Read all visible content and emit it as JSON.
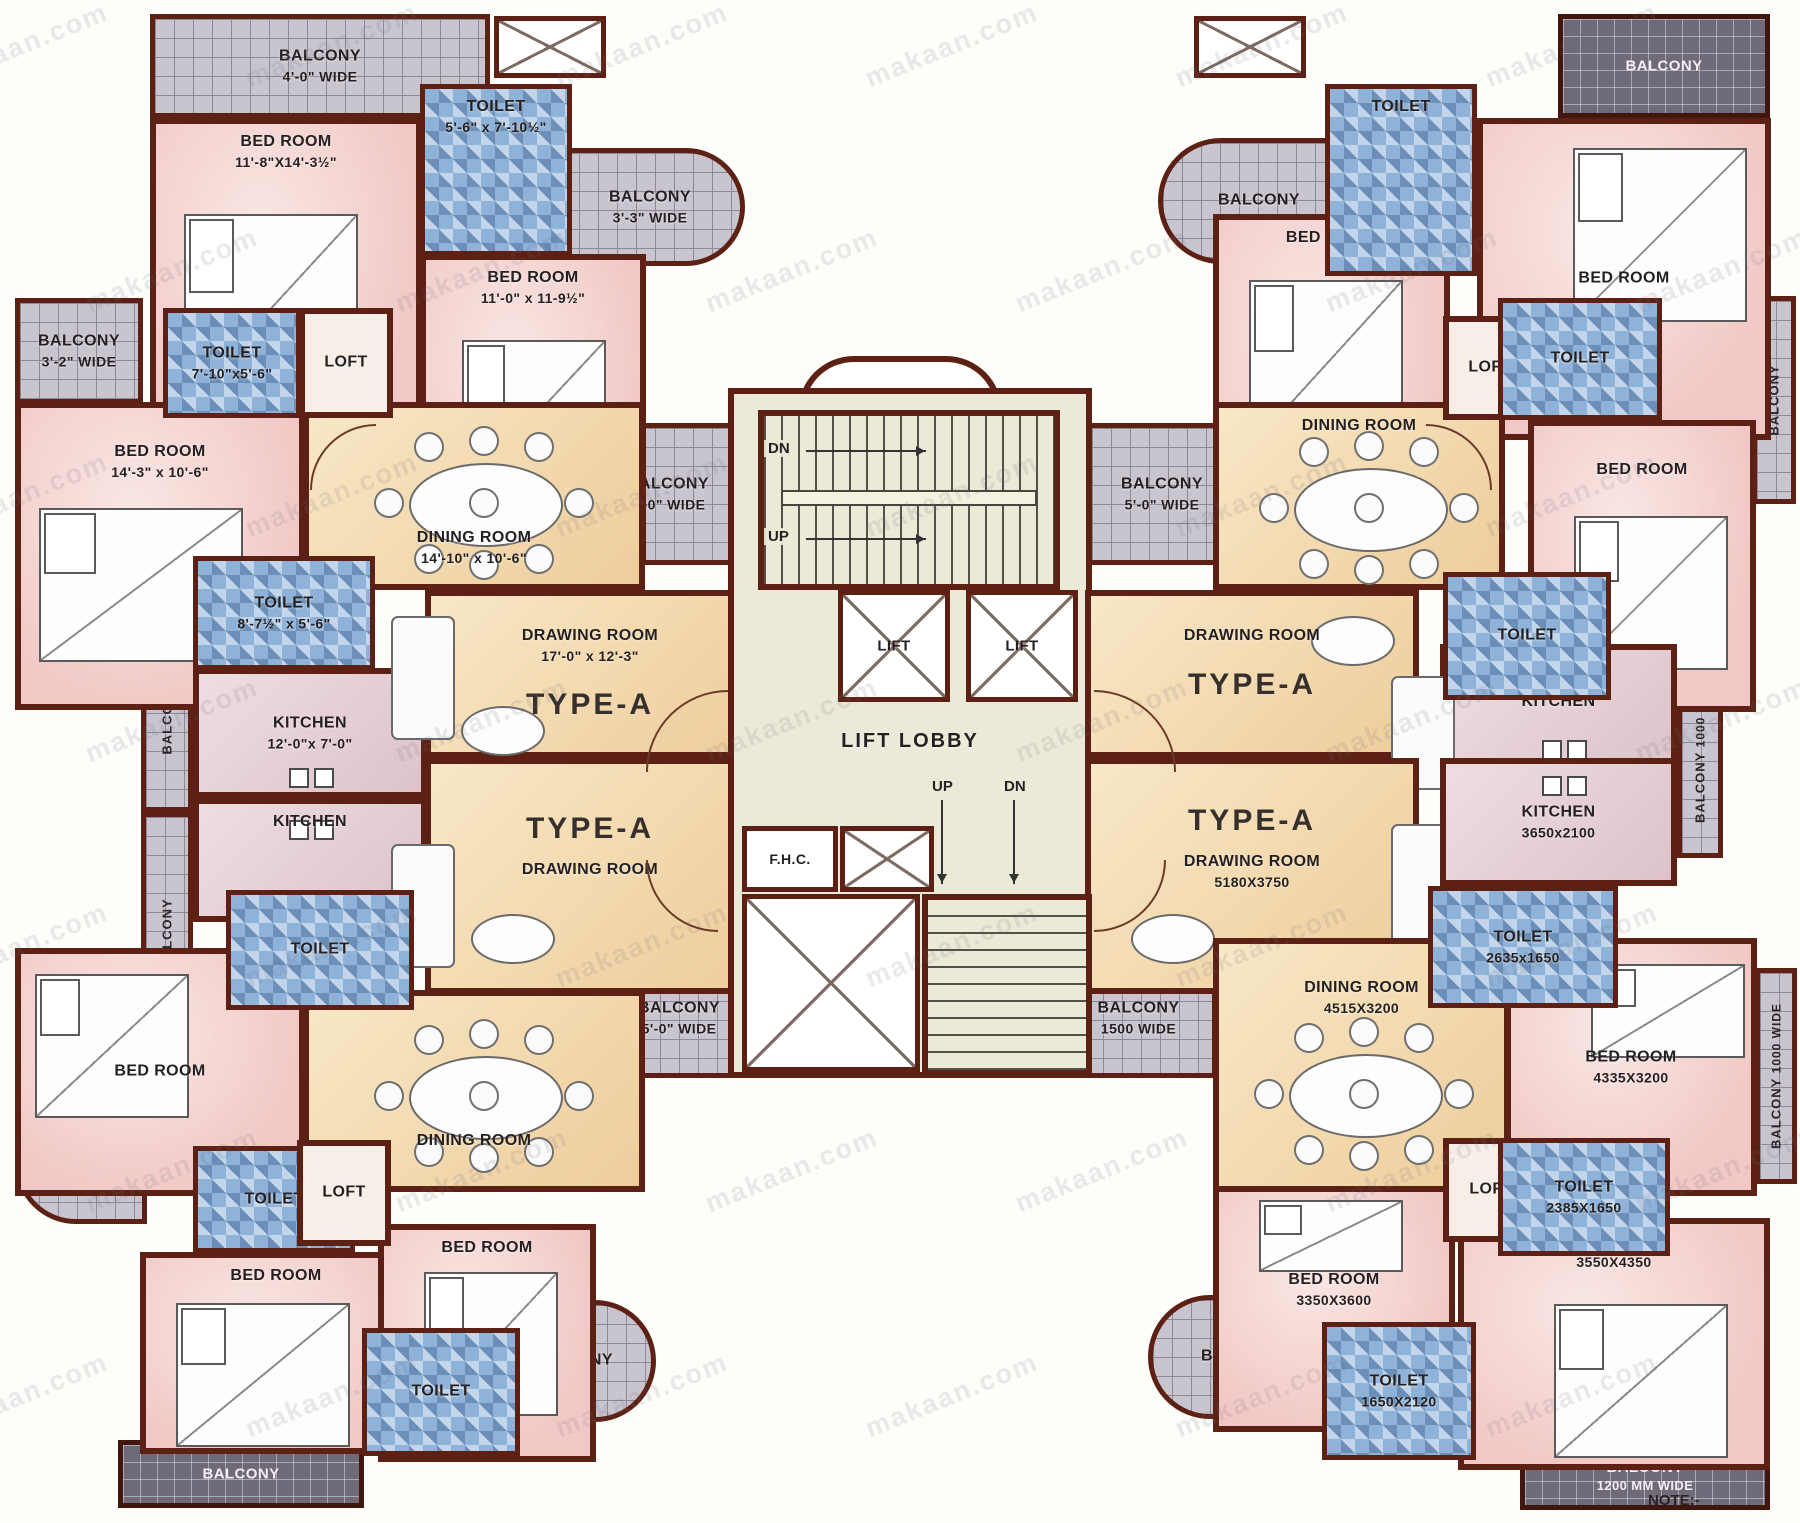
{
  "watermark": "makaan.com",
  "note": "NOTE:-",
  "core": {
    "lift": "LIFT",
    "lobby": "LIFT LOBBY",
    "fhc": "F.H.C.",
    "up": "UP",
    "dn": "DN"
  },
  "tl": {
    "type": "TYPE-A",
    "balcony_top": {
      "name": "BALCONY",
      "dims": "4'-0\" WIDE"
    },
    "bedroom1": {
      "name": "BED ROOM",
      "dims": "11'-8\"X14'-3½\""
    },
    "toilet1": {
      "name": "TOILET",
      "dims": "5'-6\" x 7'-10½\""
    },
    "balcony_right": {
      "name": "BALCONY",
      "dims": "3'-3\" WIDE"
    },
    "bedroom2": {
      "name": "BED ROOM",
      "dims": "11'-0\" x 11-9½\""
    },
    "balcony_left": {
      "name": "BALCONY",
      "dims": "3'-2\" WIDE"
    },
    "toilet2": {
      "name": "TOILET",
      "dims": "7'-10\"x5'-6\""
    },
    "loft": {
      "name": "LOFT"
    },
    "bedroom3": {
      "name": "BED ROOM",
      "dims": "14'-3\" x 10'-6\""
    },
    "dining": {
      "name": "DINING ROOM",
      "dims": "14'-10\" x 10'-6\""
    },
    "toilet3": {
      "name": "TOILET",
      "dims": "8'-7½\" x 5'-6\""
    },
    "kitchen": {
      "name": "KITCHEN",
      "dims": "12'-0\"x 7'-0\""
    },
    "balcony_vert": {
      "name": "BALCONY",
      "dims": "3'3\" WIDE"
    },
    "drawing": {
      "name": "DRAWING ROOM",
      "dims": "17'-0\" x 12'-3\""
    },
    "balcony_core": {
      "name": "BALCONY",
      "dims": "5'-0\" WIDE"
    }
  },
  "tr": {
    "type": "TYPE-A",
    "balcony_corner": {
      "name": "BALCONY"
    },
    "toilet1": {
      "name": "TOILET"
    },
    "bedroom1": {
      "name": "BED ROOM"
    },
    "balcony_round": {
      "name": "BALCONY"
    },
    "bedroom2": {
      "name": "BED ROOM"
    },
    "dining": {
      "name": "DINING ROOM"
    },
    "loft": {
      "name": "LOFT"
    },
    "toilet2": {
      "name": "TOILET"
    },
    "bedroom3": {
      "name": "BED ROOM"
    },
    "balcony_vert": {
      "name": "BALCONY"
    },
    "toilet3": {
      "name": "TOILET"
    },
    "kitchen": {
      "name": "KITCHEN"
    },
    "drawing": {
      "name": "DRAWING ROOM"
    },
    "balcony_core": {
      "name": "BALCONY",
      "dims": "5'-0\" WIDE"
    }
  },
  "bl": {
    "type": "TYPE-A",
    "drawing": {
      "name": "DRAWING ROOM"
    },
    "balcony_band": {
      "name": "BALCONY",
      "dims": "5'-0\" WIDE"
    },
    "kitchen": {
      "name": "KITCHEN"
    },
    "toilet1": {
      "name": "TOILET"
    },
    "balcony_vert": {
      "name": "BALCONY"
    },
    "dining": {
      "name": "DINING ROOM"
    },
    "bedroom1": {
      "name": "BED ROOM"
    },
    "balcony_left": {
      "name": "BALCONY"
    },
    "toilet2": {
      "name": "TOILET"
    },
    "loft": {
      "name": "LOFT"
    },
    "bedroom2": {
      "name": "BED ROOM"
    },
    "bedroom3": {
      "name": "BED ROOM"
    },
    "toilet3": {
      "name": "TOILET"
    },
    "balcony_right": {
      "name": "BALCONY"
    },
    "balcony_bottom": {
      "name": "BALCONY"
    }
  },
  "br": {
    "type": "TYPE-A",
    "drawing": {
      "name": "DRAWING ROOM",
      "dims": "5180X3750"
    },
    "kitchen": {
      "name": "KITCHEN",
      "dims": "3650x2100"
    },
    "toilet1": {
      "name": "TOILET",
      "dims": "2635x1650"
    },
    "balcony_band": {
      "name": "BALCONY",
      "dims": "1500 WIDE"
    },
    "dining": {
      "name": "DINING ROOM",
      "dims": "4515X3200"
    },
    "bedroom1": {
      "name": "BED ROOM",
      "dims": "4335X3200"
    },
    "balcony_vert1": {
      "name": "BALCONY",
      "dims": "1000 WIDE"
    },
    "balcony_vert2": {
      "name": "BALCONY",
      "dims": "1000 WIDE"
    },
    "loft": {
      "name": "LOFT"
    },
    "toilet2": {
      "name": "TOILET",
      "dims": "2385X1650"
    },
    "bedroom2": {
      "name": "BED ROOM",
      "dims": "3350X3600"
    },
    "bedroom3": {
      "name": "BED ROOM",
      "dims": "3550X4350"
    },
    "balcony_round": {
      "name": "BALCONY"
    },
    "toilet3": {
      "name": "TOILET",
      "dims": "1650X2120"
    },
    "balcony_bottom": {
      "name": "BALCONY",
      "dims": "1200 MM WIDE"
    }
  }
}
